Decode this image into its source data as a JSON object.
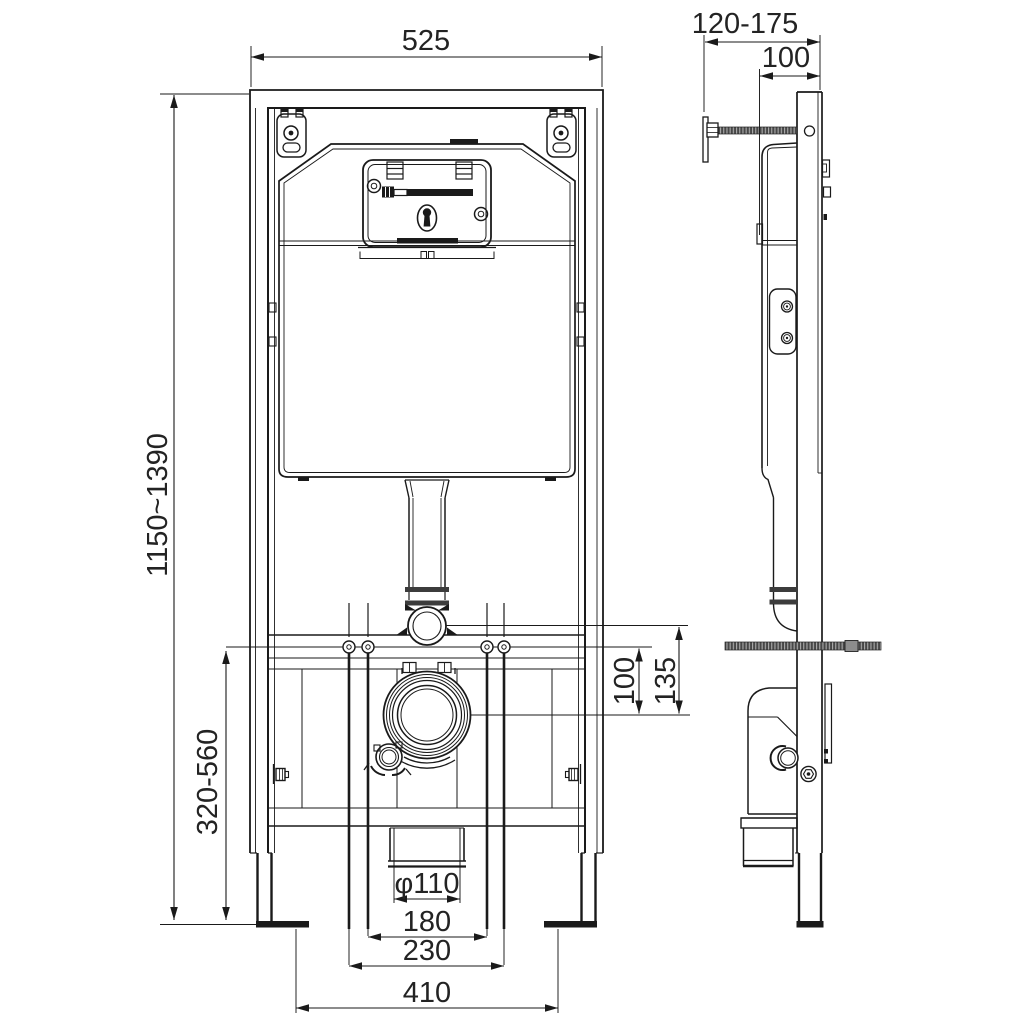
{
  "drawing": {
    "type": "technical-installation-diagram",
    "subject": "concealed-cistern-wc-frame",
    "line_color": "#1a1a1a",
    "background": "#ffffff",
    "front_view": {
      "dim_width": "525",
      "dim_height_range": "1150~1390",
      "dim_bottom_range": "320-560",
      "dim_bolt_to_drain": "100",
      "dim_flange_to_drain": "135",
      "dim_outlet_diameter": "φ110",
      "dim_bolt_spacing_inner": "180",
      "dim_bolt_spacing_outer": "230",
      "dim_feet_spacing": "410"
    },
    "side_view": {
      "dim_wall_distance_range": "120-175",
      "dim_frame_depth": "100"
    }
  }
}
